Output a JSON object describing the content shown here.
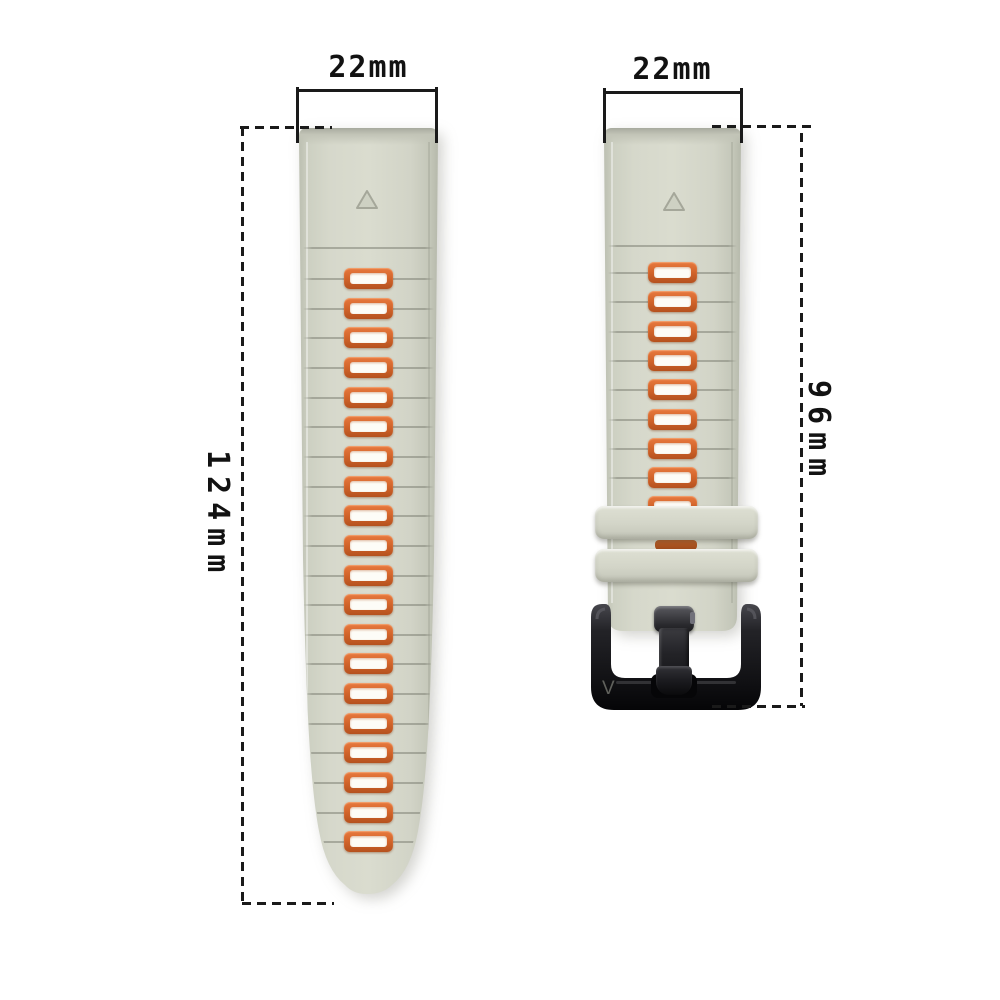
{
  "title": "watch-band-dimension-diagram",
  "annotations": {
    "left_band_width_label": "22mm",
    "right_band_width_label": "22mm",
    "left_band_length_label": "124mm",
    "right_band_length_label": "96mm",
    "line_color": "#1a1a1a"
  },
  "bands": {
    "long_band": {
      "width_label": "22mm",
      "length_label": "124mm",
      "slot_count": 20,
      "body_color": "#d4d6c9",
      "slot_ring_color": "#d4662c",
      "slot_hole_color": "#fdfcf7",
      "marker": "triangle"
    },
    "short_band": {
      "width_label": "22mm",
      "length_label": "96mm",
      "slot_count": 8,
      "clipped_slot_count": 1,
      "keeper_count": 2,
      "body_color": "#d4d6c9",
      "slot_ring_color": "#d4662c",
      "buckle_color": "#141416",
      "buckle_logo": "V",
      "marker": "triangle"
    }
  }
}
